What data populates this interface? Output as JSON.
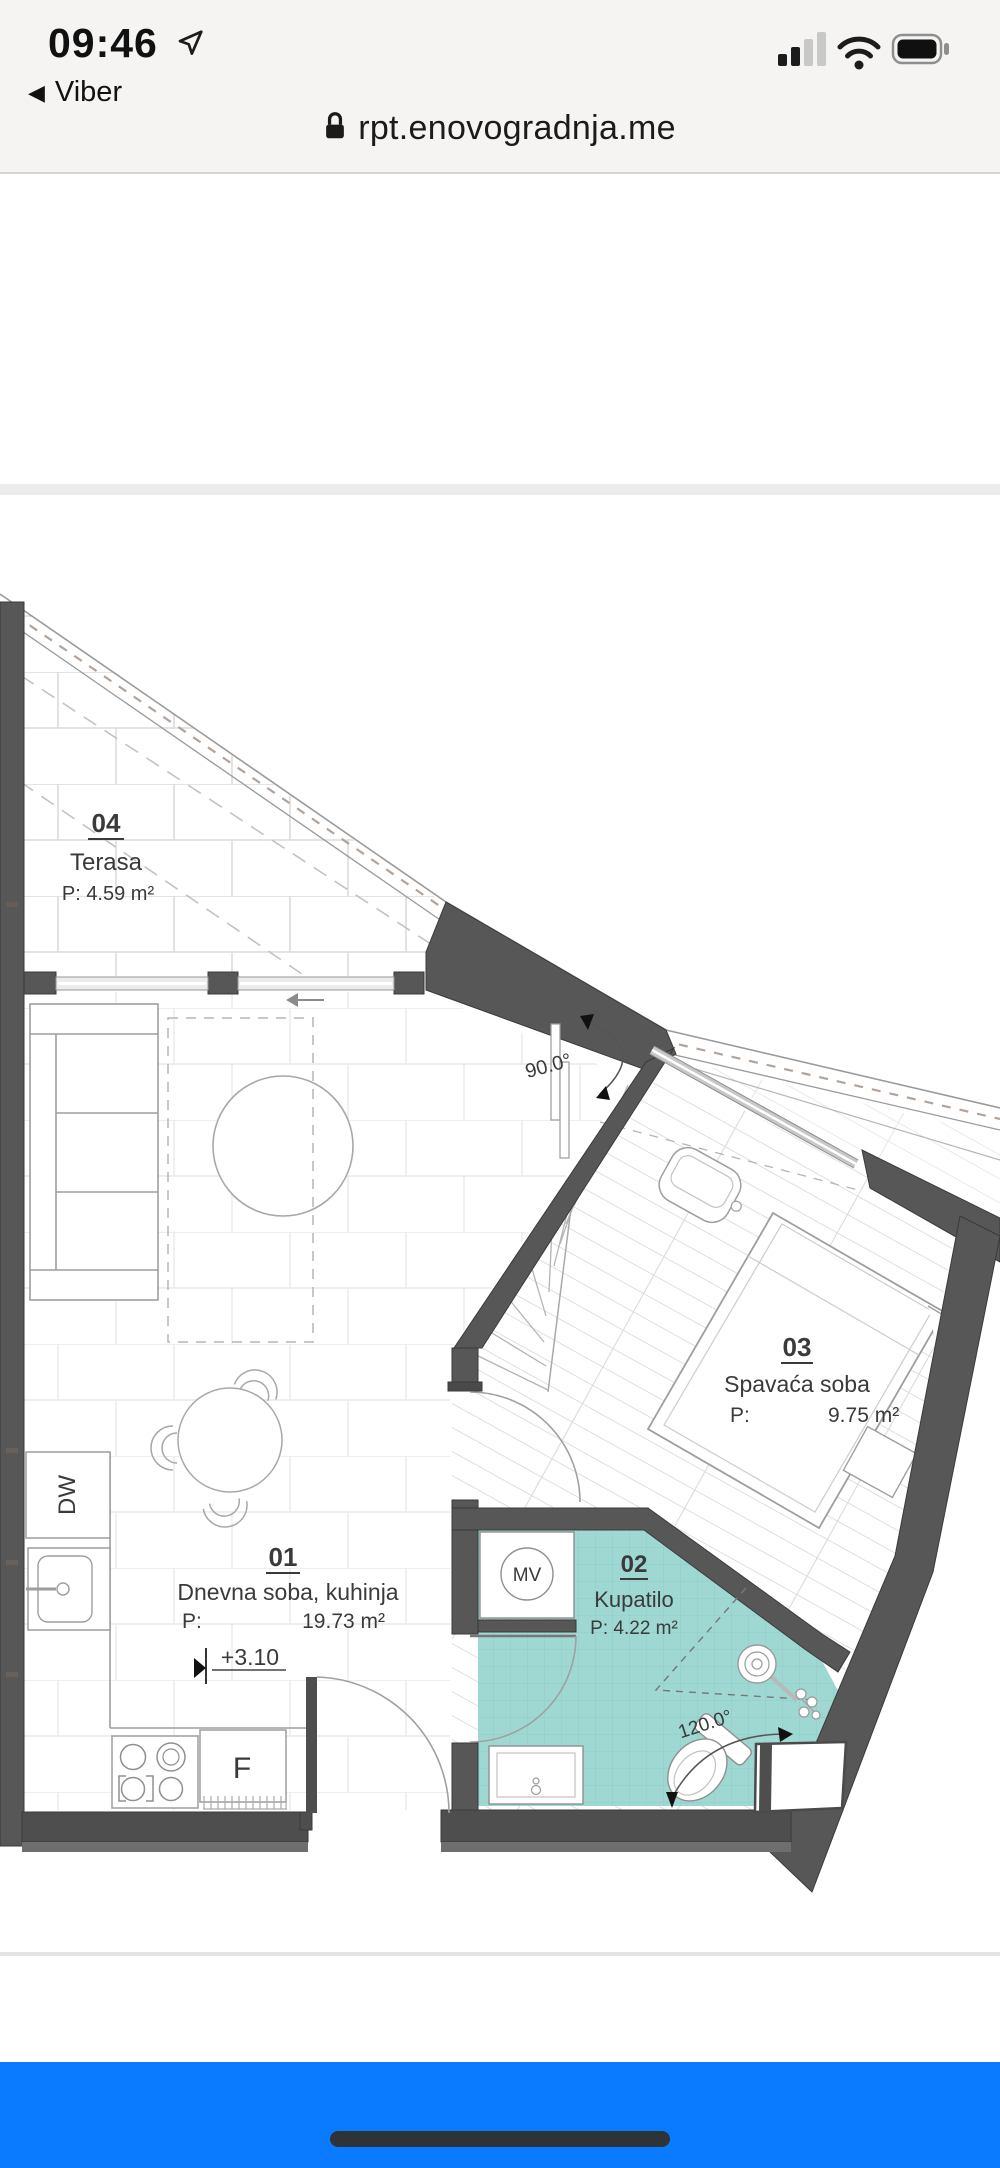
{
  "status_bar": {
    "time": "09:46",
    "back_label": "Viber",
    "back_glyph": "◀"
  },
  "url_bar": {
    "domain": "rpt.enovogradnja.me"
  },
  "plan": {
    "rooms": [
      {
        "number": "04",
        "name": "Terasa",
        "area": "P: 4.59 m²"
      },
      {
        "number": "01",
        "name": "Dnevna soba, kuhinja",
        "area_prefix": "P:",
        "area": "19.73 m²"
      },
      {
        "number": "02",
        "name": "Kupatilo",
        "area": "P: 4.22 m²"
      },
      {
        "number": "03",
        "name": "Spavaća soba",
        "area_prefix": "P:",
        "area": "9.75 m²"
      }
    ],
    "labels": {
      "vent": "MV",
      "dishwasher": "DW",
      "fridge": "F"
    },
    "annotations": {
      "corner_angle": "90.0°",
      "bath_angle": "120.0°",
      "floor_level": "+3.10"
    }
  },
  "colors": {
    "wall": "#575757",
    "bath_teal": "#9fd8d2",
    "ios_blue": "#0a7bff"
  }
}
